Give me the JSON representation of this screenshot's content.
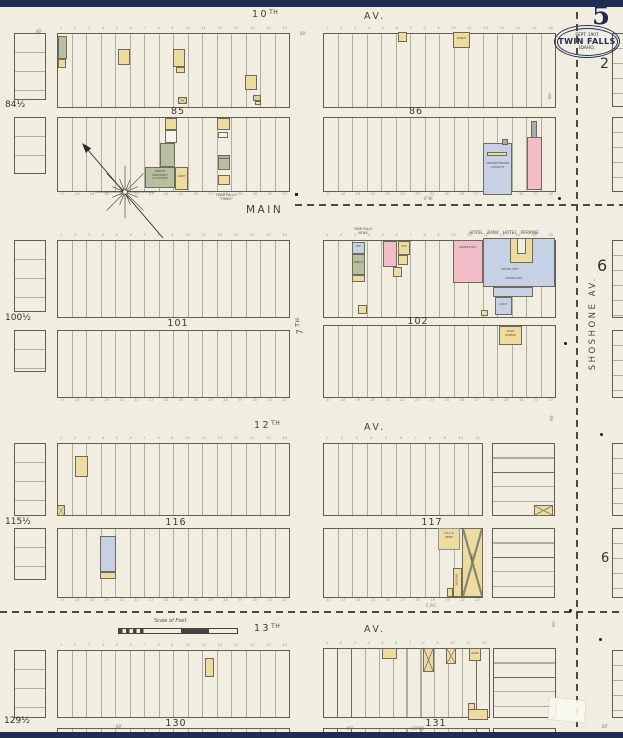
{
  "header": {
    "sheet_number": "5",
    "page_ref": "2",
    "stamp": {
      "date": "SEPT. 1907",
      "city": "TWIN FALLS",
      "state": "IDAHO."
    }
  },
  "margins": {
    "left_refs": [
      "84½",
      "100½",
      "115½",
      "129½"
    ],
    "right_refs": [
      "6",
      "6"
    ]
  },
  "streets": {
    "s10_num": "10",
    "s7_num": "7",
    "s12_num": "12",
    "s13_num": "13",
    "ord": "TH",
    "av": "AV.",
    "main": "MAIN",
    "shoshone": "SHOSHONE   AV."
  },
  "blocks": {
    "b85": "85",
    "b86": "86",
    "b101": "101",
    "b102": "102",
    "b116": "116",
    "b117": "117",
    "b130": "130",
    "b131": "131"
  },
  "annotations": {
    "times": [
      "TWIN FALLS",
      "\"TIMES\""
    ],
    "news": [
      "TWIN FALLS",
      "NEWS"
    ],
    "hotel_row": "HOTEL   BANK   HOTEL   PERRINE",
    "no_left": "NO",
    "no_right": "EXPOS-",
    "water_main": "6\"W.",
    "cpc": "C.P.C.",
    "sixty": "60'"
  },
  "buildings": {
    "paints_store": [
      "PAINTS",
      "CROCKERY",
      "& STOVES"
    ],
    "paint": "PAINT",
    "presbyterian_church": [
      "PRESBYTERIAN",
      "CHURCH"
    ],
    "sample_room": "SAMPLE RM.",
    "hotel_office": "HOTEL OFF.",
    "dining_room": "DINING RM.",
    "dray": "DRAY",
    "office": "OFF.",
    "printing": "PRINT'G",
    "sale_stable": [
      "SALE",
      "STABLE"
    ],
    "hay_feed": [
      "HAY &",
      "FEED"
    ],
    "livery": "LIVERY",
    "wagons": "WAGONS",
    "barn": "BARN"
  },
  "scale": {
    "label": "Scale of Feet"
  },
  "lots": {
    "n16": [
      "1",
      "2",
      "3",
      "4",
      "5",
      "6",
      "7",
      "8",
      "9",
      "10",
      "11",
      "12",
      "13",
      "14",
      "15",
      "16"
    ],
    "n17_32": [
      "17",
      "18",
      "19",
      "20",
      "21",
      "22",
      "23",
      "24",
      "25",
      "26",
      "27",
      "28",
      "29",
      "30",
      "31",
      "32"
    ],
    "n11": [
      "1",
      "2",
      "3",
      "4",
      "5",
      "6",
      "7",
      "8",
      "9",
      "10",
      "11"
    ],
    "n12": [
      "1",
      "2",
      "3",
      "4",
      "5",
      "6",
      "7",
      "8",
      "9",
      "10",
      "11",
      "12"
    ],
    "n12_22": [
      "12",
      "13",
      "14",
      "15",
      "16",
      "17",
      "18",
      "19",
      "20",
      "21",
      "22"
    ]
  }
}
